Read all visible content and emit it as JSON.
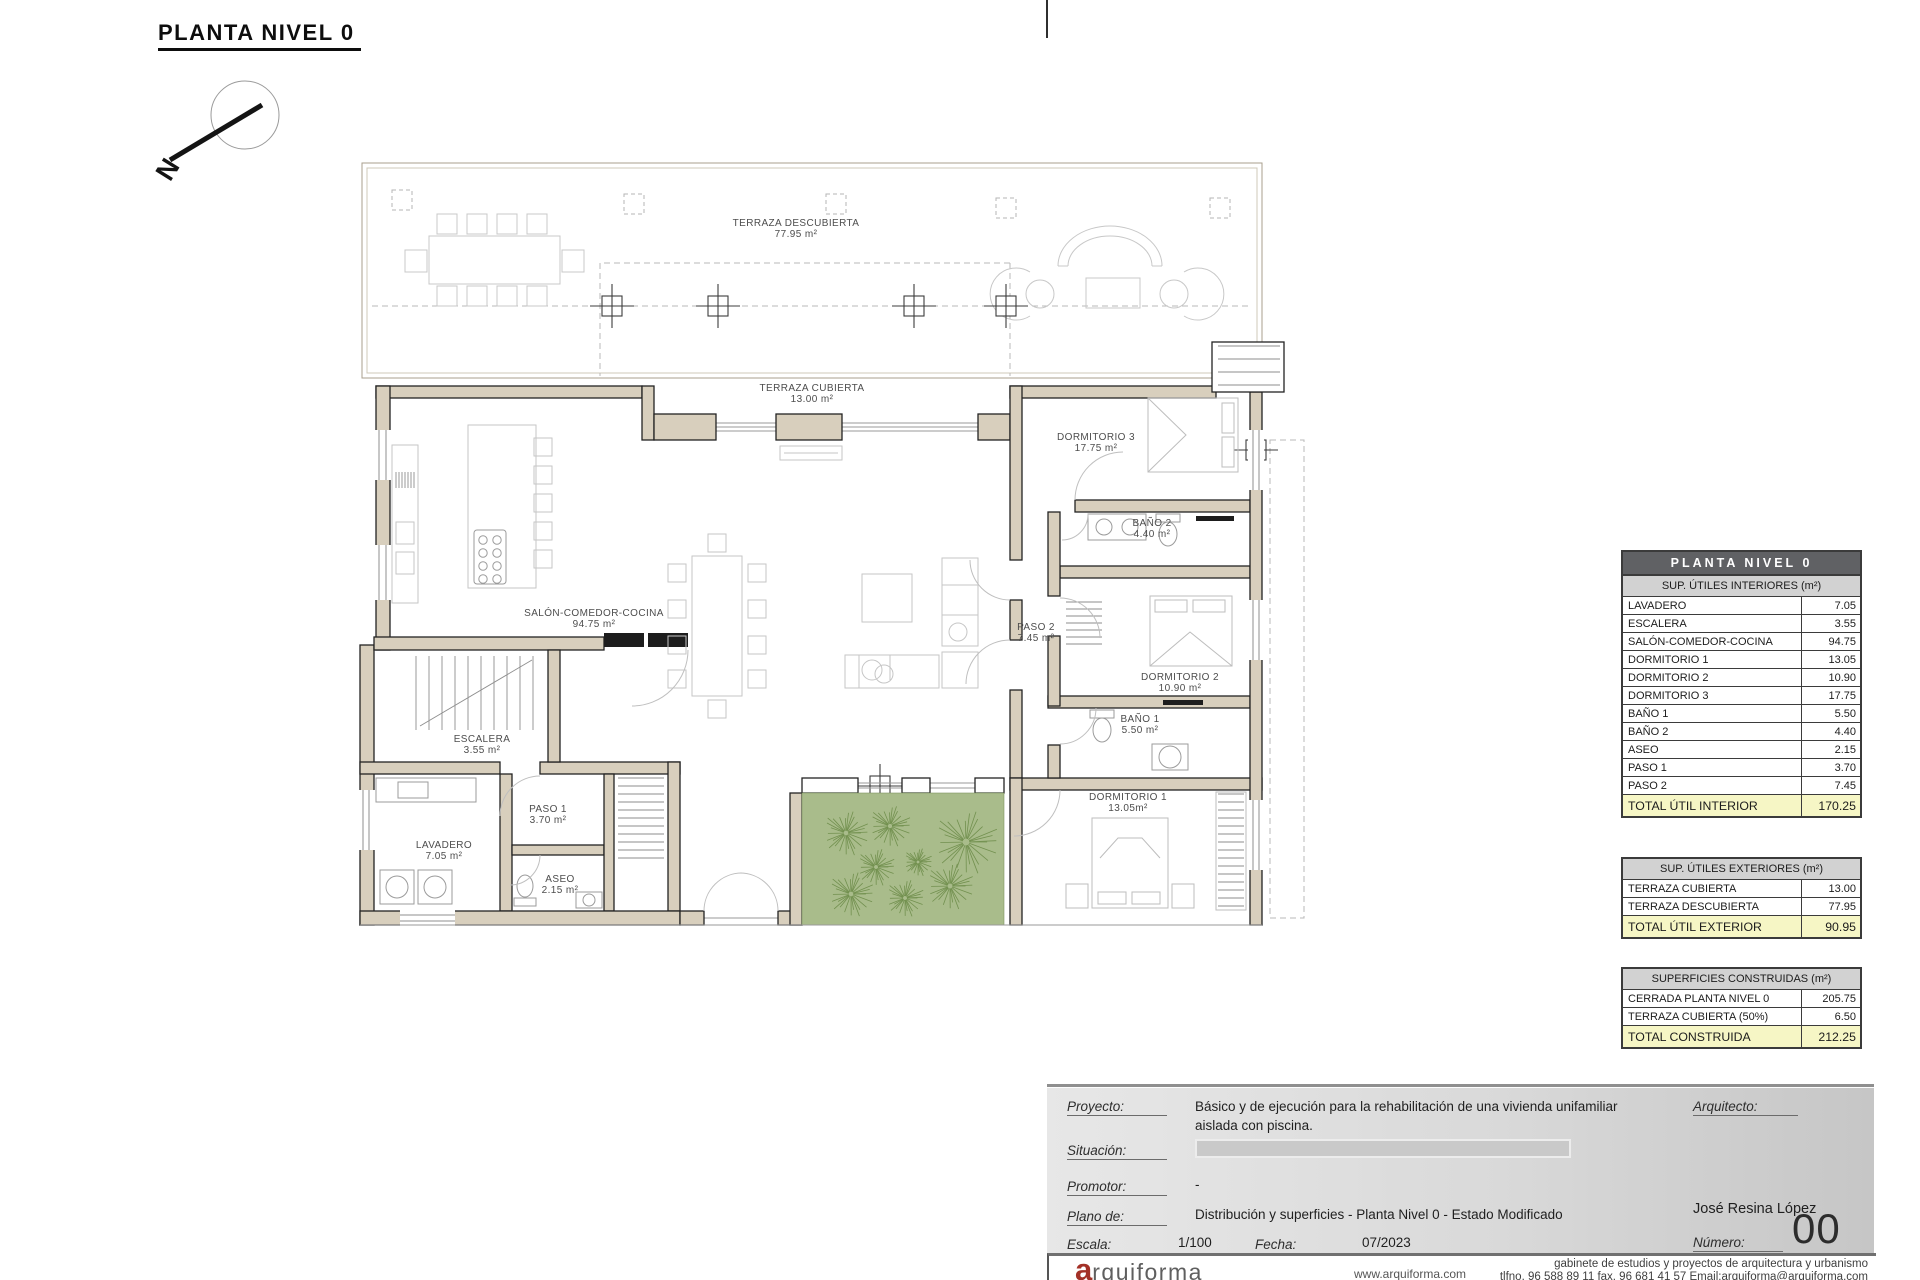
{
  "sheet": {
    "title": "PLANTA NIVEL 0",
    "north_letter": "N"
  },
  "plan": {
    "rooms": [
      {
        "name": "TERRAZA DESCUBIERTA",
        "area": "77.95 m²"
      },
      {
        "name": "TERRAZA CUBIERTA",
        "area": "13.00 m²"
      },
      {
        "name": "DORMITORIO 3",
        "area": "17.75 m²"
      },
      {
        "name": "BAÑO 2",
        "area": "4.40 m²"
      },
      {
        "name": "SALÓN-COMEDOR-COCINA",
        "area": "94.75 m²"
      },
      {
        "name": "PASO 2",
        "area": "7.45 m²"
      },
      {
        "name": "DORMITORIO 2",
        "area": "10.90 m²"
      },
      {
        "name": "BAÑO 1",
        "area": "5.50 m²"
      },
      {
        "name": "ESCALERA",
        "area": "3.55 m²"
      },
      {
        "name": "DORMITORIO 1",
        "area": "13.05m²"
      },
      {
        "name": "PASO 1",
        "area": "3.70 m²"
      },
      {
        "name": "LAVADERO",
        "area": "7.05 m²"
      },
      {
        "name": "ASEO",
        "area": "2.15 m²"
      }
    ],
    "trees": [
      [
        846,
        833,
        24
      ],
      [
        890,
        826,
        22
      ],
      [
        876,
        867,
        20
      ],
      [
        851,
        894,
        24
      ],
      [
        905,
        898,
        20
      ],
      [
        950,
        886,
        25
      ],
      [
        966,
        842,
        34
      ],
      [
        918,
        862,
        15
      ]
    ]
  },
  "tables": {
    "interior": {
      "title": "PLANTA NIVEL 0",
      "subtitle": "SUP. ÚTILES INTERIORES (m²)",
      "rows": [
        [
          "LAVADERO",
          "7.05"
        ],
        [
          "ESCALERA",
          "3.55"
        ],
        [
          "SALÓN-COMEDOR-COCINA",
          "94.75"
        ],
        [
          "DORMITORIO 1",
          "13.05"
        ],
        [
          "DORMITORIO 2",
          "10.90"
        ],
        [
          "DORMITORIO 3",
          "17.75"
        ],
        [
          "BAÑO 1",
          "5.50"
        ],
        [
          "BAÑO 2",
          "4.40"
        ],
        [
          "ASEO",
          "2.15"
        ],
        [
          "PASO 1",
          "3.70"
        ],
        [
          "PASO 2",
          "7.45"
        ]
      ],
      "total": [
        "TOTAL ÚTIL INTERIOR",
        "170.25"
      ]
    },
    "exterior": {
      "subtitle": "SUP. ÚTILES EXTERIORES (m²)",
      "rows": [
        [
          "TERRAZA CUBIERTA",
          "13.00"
        ],
        [
          "TERRAZA DESCUBIERTA",
          "77.95"
        ]
      ],
      "total": [
        "TOTAL ÚTIL EXTERIOR",
        "90.95"
      ]
    },
    "construidas": {
      "subtitle": "SUPERFICIES CONSTRUIDAS (m²)",
      "rows": [
        [
          "CERRADA PLANTA NIVEL 0",
          "205.75"
        ],
        [
          "TERRAZA CUBIERTA (50%)",
          "6.50"
        ]
      ],
      "total": [
        "TOTAL CONSTRUIDA",
        "212.25"
      ]
    }
  },
  "titleblock": {
    "proyecto": {
      "label": "Proyecto:",
      "value": "Básico y de ejecución para la rehabilitación de una vivienda unifamiliar aislada con piscina."
    },
    "situacion": {
      "label": "Situación:"
    },
    "promotor": {
      "label": "Promotor:",
      "value": "-"
    },
    "plano_de": {
      "label": "Plano de:",
      "value": "Distribución y superficies - Planta Nivel 0 - Estado Modificado"
    },
    "escala": {
      "label": "Escala:",
      "value": "1/100"
    },
    "fecha": {
      "label": "Fecha:",
      "value": "07/2023"
    },
    "arquitecto": {
      "label": "Arquitecto:",
      "name": "José Resina López"
    },
    "numero": {
      "label": "Número:",
      "value": "00"
    }
  },
  "footer": {
    "logo_first": "a",
    "logo_rest": "rquiforma",
    "web": "www.arquiforma.com",
    "firm_line1": "gabinete de estudios y proyectos de arquitectura y urbanismo",
    "firm_line2": "tlfno. 96 588 89 11  fax. 96 681 41 57  Email:arquiforma@arquiforma.com"
  },
  "colors": {
    "wall_tan": "#d8cfbd",
    "garden_green": "#a9bc8b",
    "tree_green": "#72904f",
    "total_yellow": "#f6f6c5",
    "header_dark": "#606164",
    "header_light": "#d2d2d2",
    "logo_red": "#a33127"
  }
}
